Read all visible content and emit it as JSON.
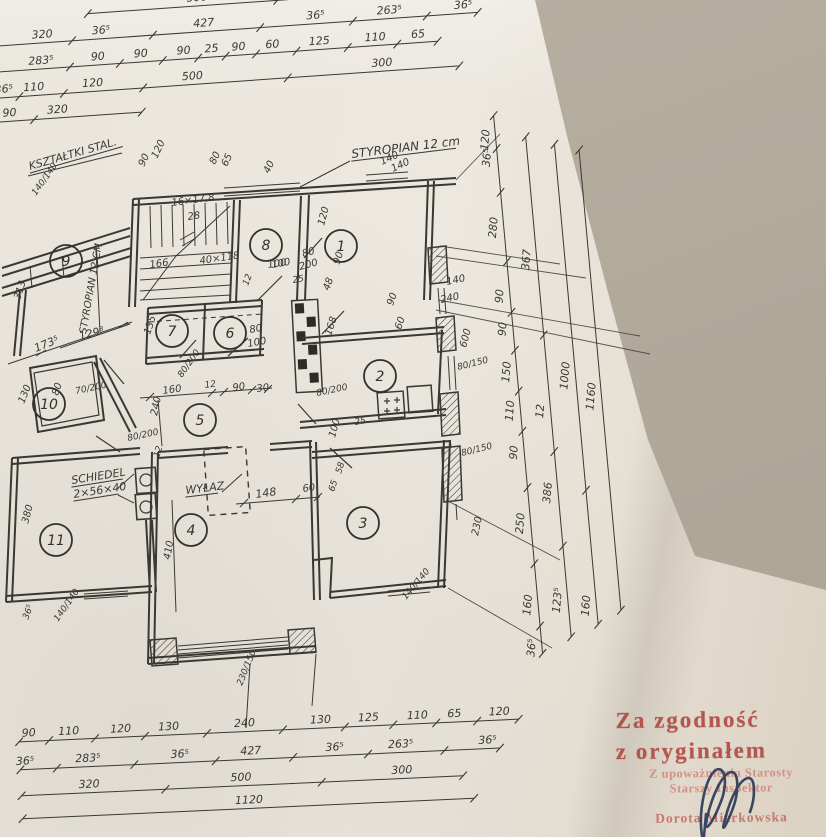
{
  "stamp": {
    "line1": "Za zgodność",
    "line2": "z oryginałem",
    "line3": "Z upoważnienia Starosty",
    "line4": "Starszy Inspektor",
    "name": "Dorota Mierkowska",
    "ink_dark": "#ad453e",
    "ink_light": "#d28d83",
    "signature_color": "#2c3a57"
  },
  "dims": {
    "top": [
      [
        "500",
        "300"
      ],
      [
        "320",
        "36⁵",
        "427",
        "36⁵",
        "263⁵",
        "36⁵"
      ],
      [
        "283⁵",
        "90",
        "90",
        "90",
        "25",
        "90",
        "60",
        "125",
        "110",
        "65"
      ],
      [
        "36⁵",
        "110",
        "120",
        "500",
        "300"
      ],
      [
        "90",
        "320"
      ]
    ],
    "bottom": [
      [
        "90",
        "110",
        "120",
        "130",
        "240",
        "130",
        "125",
        "110",
        "65",
        "120"
      ],
      [
        "36⁵",
        "283⁵",
        "36⁵",
        "427",
        "36⁵",
        "263⁵",
        "36⁵"
      ],
      [
        "320",
        "500",
        "300"
      ],
      [
        "1120"
      ]
    ],
    "right": [
      [
        "120",
        "36⁵",
        "280",
        "90",
        "90",
        "150",
        "110",
        "90",
        "250",
        "160",
        "36⁵"
      ],
      [
        "367",
        "12",
        "386",
        "123⁵"
      ],
      [
        "1000",
        "160"
      ],
      [
        "1160"
      ]
    ]
  },
  "plan": {
    "rooms": [
      {
        "n": "1",
        "x": 341,
        "y": 246
      },
      {
        "n": "2",
        "x": 380,
        "y": 376
      },
      {
        "n": "3",
        "x": 363,
        "y": 523
      },
      {
        "n": "4",
        "x": 191,
        "y": 530
      },
      {
        "n": "5",
        "x": 200,
        "y": 420
      },
      {
        "n": "6",
        "x": 230,
        "y": 333
      },
      {
        "n": "7",
        "x": 172,
        "y": 331
      },
      {
        "n": "8",
        "x": 266,
        "y": 245
      },
      {
        "n": "9",
        "x": 66,
        "y": 261
      },
      {
        "n": "10",
        "x": 49,
        "y": 404
      },
      {
        "n": "11",
        "x": 56,
        "y": 540
      }
    ],
    "annotations": [
      {
        "t": "KSZTAŁTKI STAL.",
        "x": 30,
        "y": 170,
        "r": -16,
        "fs": 11,
        "u": 1,
        "name": "label-ksztaltki-stal"
      },
      {
        "t": "STYROPIAN 12 CM",
        "x": 86,
        "y": 334,
        "r": -80,
        "fs": 10,
        "name": "label-styropian-left"
      },
      {
        "t": "STYROPIAN 12 cm",
        "x": 352,
        "y": 158,
        "r": -7,
        "fs": 12,
        "u": 1,
        "name": "label-styropian-top"
      },
      {
        "t": "SCHIEDEL",
        "x": 72,
        "y": 484,
        "r": -9,
        "fs": 11,
        "u": 1,
        "name": "label-schiedel"
      },
      {
        "t": "2×56×40",
        "x": 74,
        "y": 498,
        "r": -9,
        "fs": 11,
        "u": 1,
        "name": "label-schiedel-size"
      },
      {
        "t": "WYŁAZ",
        "x": 186,
        "y": 494,
        "r": -7,
        "fs": 11,
        "u": 1,
        "name": "label-wylaz"
      },
      {
        "t": "16×17,8",
        "x": 172,
        "y": 206,
        "r": -8,
        "fs": 10
      },
      {
        "t": "28",
        "x": 188,
        "y": 220,
        "r": -8,
        "fs": 10
      },
      {
        "t": "166",
        "x": 150,
        "y": 268,
        "r": -8,
        "fs": 10
      },
      {
        "t": "40×118",
        "x": 200,
        "y": 264,
        "r": -8,
        "fs": 10
      },
      {
        "t": "100",
        "x": 268,
        "y": 268,
        "r": -8,
        "fs": 10
      },
      {
        "t": "12",
        "x": 248,
        "y": 286,
        "r": -70,
        "fs": 9
      },
      {
        "t": "90",
        "x": 144,
        "y": 167,
        "r": -65,
        "fs": 10
      },
      {
        "t": "120",
        "x": 157,
        "y": 159,
        "r": -65,
        "fs": 10
      },
      {
        "t": "80",
        "x": 215,
        "y": 165,
        "r": -65,
        "fs": 10
      },
      {
        "t": "65",
        "x": 227,
        "y": 167,
        "r": -65,
        "fs": 10
      },
      {
        "t": "40",
        "x": 269,
        "y": 174,
        "r": -65,
        "fs": 10
      },
      {
        "t": "140",
        "x": 382,
        "y": 165,
        "r": -25,
        "fs": 10
      },
      {
        "t": "140",
        "x": 393,
        "y": 172,
        "r": -25,
        "fs": 10
      },
      {
        "t": "140/140",
        "x": 36,
        "y": 196,
        "r": -55,
        "fs": 9
      },
      {
        "t": "120",
        "x": 324,
        "y": 226,
        "r": -75,
        "fs": 10
      },
      {
        "t": "80",
        "x": 303,
        "y": 257,
        "r": -15,
        "fs": 10
      },
      {
        "t": "200",
        "x": 300,
        "y": 270,
        "r": -15,
        "fs": 10
      },
      {
        "t": "100",
        "x": 272,
        "y": 268,
        "r": -10,
        "fs": 10
      },
      {
        "t": "25",
        "x": 293,
        "y": 283,
        "r": -10,
        "fs": 9
      },
      {
        "t": "48",
        "x": 329,
        "y": 291,
        "r": -70,
        "fs": 10
      },
      {
        "t": "90",
        "x": 339,
        "y": 265,
        "r": -70,
        "fs": 10
      },
      {
        "t": "140",
        "x": 447,
        "y": 285,
        "r": -12,
        "fs": 10
      },
      {
        "t": "240",
        "x": 441,
        "y": 303,
        "r": -12,
        "fs": 10
      },
      {
        "t": "135",
        "x": 150,
        "y": 335,
        "r": -72,
        "fs": 10
      },
      {
        "t": "80",
        "x": 250,
        "y": 333,
        "r": -10,
        "fs": 10
      },
      {
        "t": "100",
        "x": 248,
        "y": 347,
        "r": -10,
        "fs": 10
      },
      {
        "t": "80/200",
        "x": 182,
        "y": 378,
        "r": -55,
        "fs": 9
      },
      {
        "t": "168",
        "x": 331,
        "y": 336,
        "r": -72,
        "fs": 10
      },
      {
        "t": "90",
        "x": 393,
        "y": 306,
        "r": -72,
        "fs": 10
      },
      {
        "t": "60",
        "x": 401,
        "y": 330,
        "r": -72,
        "fs": 10
      },
      {
        "t": "160",
        "x": 163,
        "y": 394,
        "r": -8,
        "fs": 10
      },
      {
        "t": "12",
        "x": 205,
        "y": 388,
        "r": -8,
        "fs": 9
      },
      {
        "t": "90",
        "x": 233,
        "y": 391,
        "r": -8,
        "fs": 10
      },
      {
        "t": "30",
        "x": 257,
        "y": 392,
        "r": -8,
        "fs": 10
      },
      {
        "t": "240",
        "x": 157,
        "y": 416,
        "r": -78,
        "fs": 10
      },
      {
        "t": "80/200",
        "x": 128,
        "y": 441,
        "r": -12,
        "fs": 9
      },
      {
        "t": "12",
        "x": 159,
        "y": 458,
        "r": -72,
        "fs": 9
      },
      {
        "t": "80/200",
        "x": 317,
        "y": 396,
        "r": -12,
        "fs": 9
      },
      {
        "t": "100",
        "x": 335,
        "y": 438,
        "r": -75,
        "fs": 10
      },
      {
        "t": "25",
        "x": 355,
        "y": 425,
        "r": -10,
        "fs": 9
      },
      {
        "t": "173⁵",
        "x": 36,
        "y": 352,
        "r": -22,
        "fs": 11
      },
      {
        "t": "129⁸",
        "x": 80,
        "y": 340,
        "r": -14,
        "fs": 11
      },
      {
        "t": "70/200",
        "x": 76,
        "y": 394,
        "r": -12,
        "fs": 9
      },
      {
        "t": "80",
        "x": 58,
        "y": 396,
        "r": -72,
        "fs": 10
      },
      {
        "t": "130",
        "x": 24,
        "y": 404,
        "r": -68,
        "fs": 10
      },
      {
        "t": "313",
        "x": 20,
        "y": 300,
        "r": -72,
        "fs": 10
      },
      {
        "t": "380",
        "x": 28,
        "y": 524,
        "r": -75,
        "fs": 10
      },
      {
        "t": "410",
        "x": 170,
        "y": 560,
        "r": -80,
        "fs": 10
      },
      {
        "t": "230/150",
        "x": 242,
        "y": 686,
        "r": -68,
        "fs": 9
      },
      {
        "t": "140/140",
        "x": 58,
        "y": 622,
        "r": -55,
        "fs": 9
      },
      {
        "t": "36⁵",
        "x": 28,
        "y": 620,
        "r": -70,
        "fs": 9
      },
      {
        "t": "148",
        "x": 256,
        "y": 498,
        "r": -8,
        "fs": 11
      },
      {
        "t": "60",
        "x": 303,
        "y": 492,
        "r": -8,
        "fs": 10
      },
      {
        "t": "65",
        "x": 334,
        "y": 492,
        "r": -72,
        "fs": 9
      },
      {
        "t": "58",
        "x": 341,
        "y": 474,
        "r": -72,
        "fs": 9
      },
      {
        "t": "140/140",
        "x": 406,
        "y": 600,
        "r": -50,
        "fs": 9
      },
      {
        "t": "80/150",
        "x": 458,
        "y": 370,
        "r": -14,
        "fs": 9
      },
      {
        "t": "80/150",
        "x": 462,
        "y": 456,
        "r": -14,
        "fs": 9
      },
      {
        "t": "600",
        "x": 466,
        "y": 348,
        "r": -75,
        "fs": 10
      },
      {
        "t": "230",
        "x": 478,
        "y": 536,
        "r": -78,
        "fs": 10
      }
    ]
  }
}
